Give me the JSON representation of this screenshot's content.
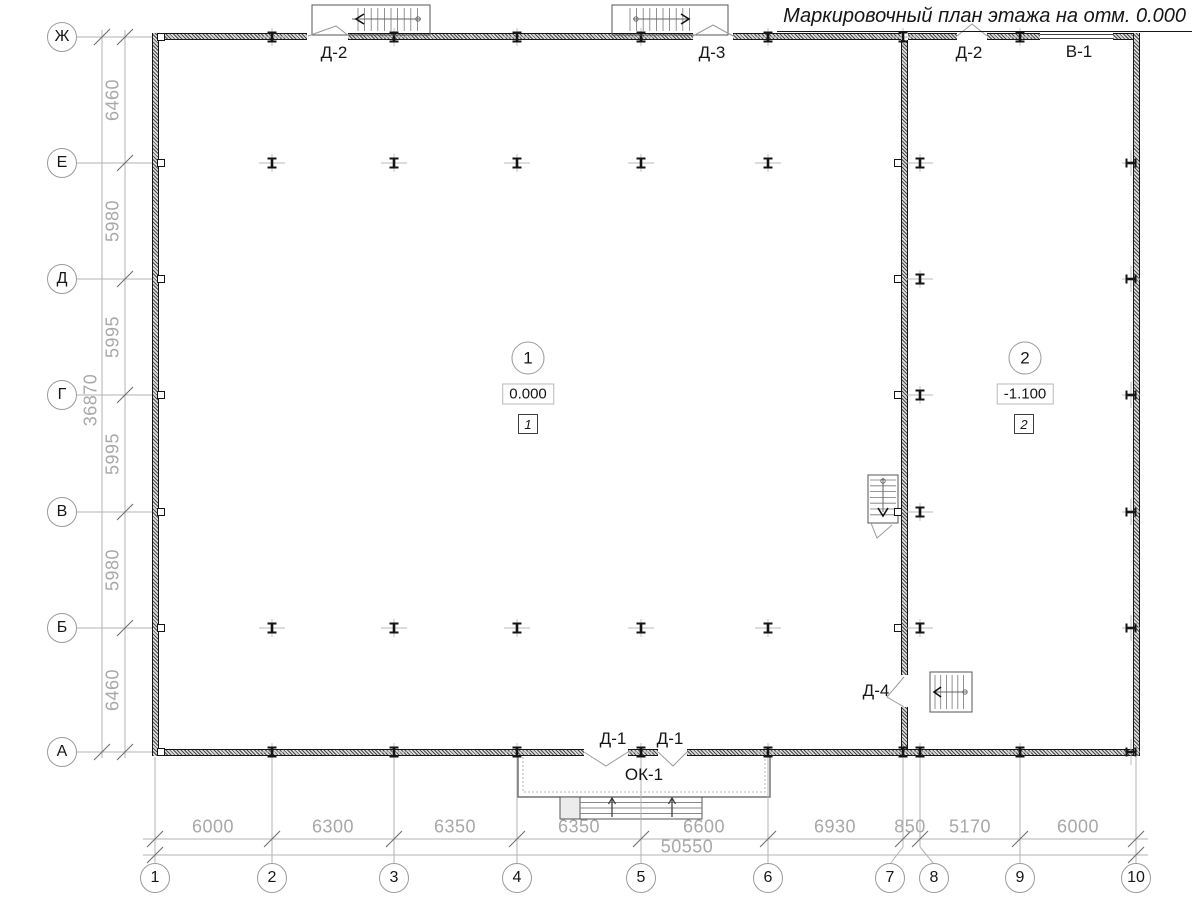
{
  "title": "Маркировочный план этажа на отм. 0.000",
  "colors": {
    "line_gray": "#b3b3b3",
    "tick_gray": "#6e6e6e",
    "dim_text_gray": "#a8a8a8",
    "drawing_black": "#151515",
    "thin_detail": "#777777",
    "swing_gray": "#9a9a9a"
  },
  "grid": {
    "rows": [
      {
        "label": "Ж",
        "y": 37
      },
      {
        "label": "Е",
        "y": 163
      },
      {
        "label": "Д",
        "y": 279
      },
      {
        "label": "Г",
        "y": 395
      },
      {
        "label": "В",
        "y": 512
      },
      {
        "label": "Б",
        "y": 628
      },
      {
        "label": "А",
        "y": 752
      }
    ],
    "cols": [
      {
        "label": "1",
        "x": 155,
        "bx": 155
      },
      {
        "label": "2",
        "x": 272,
        "bx": 272
      },
      {
        "label": "3",
        "x": 394,
        "bx": 394
      },
      {
        "label": "4",
        "x": 517,
        "bx": 517
      },
      {
        "label": "5",
        "x": 641,
        "bx": 641
      },
      {
        "label": "6",
        "x": 768,
        "bx": 768
      },
      {
        "label": "7",
        "x": 903,
        "bx": 890
      },
      {
        "label": "8",
        "x": 920,
        "bx": 934
      },
      {
        "label": "9",
        "x": 1020,
        "bx": 1020
      },
      {
        "label": "10",
        "x": 1136,
        "bx": 1136
      }
    ]
  },
  "dims": {
    "v_segments": [
      {
        "text": "6460",
        "y": 100
      },
      {
        "text": "5980",
        "y": 221
      },
      {
        "text": "5995",
        "y": 337
      },
      {
        "text": "5995",
        "y": 454
      },
      {
        "text": "5980",
        "y": 570
      },
      {
        "text": "6460",
        "y": 690
      }
    ],
    "v_total": {
      "text": "36870",
      "x": 91,
      "y": 400
    },
    "h_segments": [
      {
        "text": "6000",
        "x": 213
      },
      {
        "text": "6300",
        "x": 333
      },
      {
        "text": "6350",
        "x": 455
      },
      {
        "text": "6350",
        "x": 579
      },
      {
        "text": "6600",
        "x": 704
      },
      {
        "text": "6930",
        "x": 835
      },
      {
        "text": "850",
        "x": 910
      },
      {
        "text": "5170",
        "x": 970
      },
      {
        "text": "6000",
        "x": 1078
      }
    ],
    "h_total": {
      "text": "50550",
      "x": 687,
      "y": 847
    }
  },
  "labels": {
    "door_top_left": "Д-2",
    "door_top_mid": "Д-3",
    "door_top_right": "Д-2",
    "window_top": "В-1",
    "door_bottom_left": "Д-1",
    "door_bottom_right": "Д-1",
    "entrance": "ОК-1",
    "door_interior": "Д-4"
  },
  "rooms": [
    {
      "number": "1",
      "elevation": "0.000",
      "tag": "1"
    },
    {
      "number": "2",
      "elevation": "-1.100",
      "tag": "2"
    }
  ],
  "markers": {
    "free_cols_x": [
      272,
      394,
      517,
      641,
      768
    ],
    "free_rows_y": [
      163,
      628
    ],
    "axis8_x": 920,
    "axis8_rows_y": [
      163,
      279,
      395,
      512,
      628
    ],
    "top_wall_x": [
      272,
      394,
      517,
      641,
      768,
      903,
      1020
    ],
    "bottom_wall_x": [
      272,
      394,
      517,
      641,
      768,
      903,
      920,
      1020
    ],
    "left_wall_rows_y": [
      37,
      163,
      279,
      395,
      512,
      628,
      752
    ],
    "inner_wall_rows_y": [
      163,
      279,
      395,
      512,
      628
    ],
    "right_wall_rows_y": [
      163,
      279,
      395,
      512,
      628,
      752
    ]
  }
}
